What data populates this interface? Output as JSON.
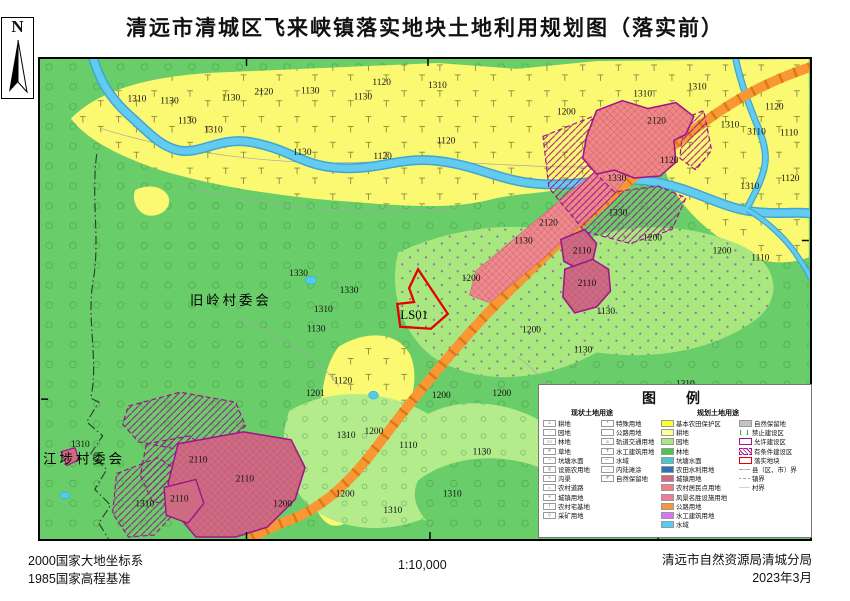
{
  "title": "清远市清城区飞来峡镇落实地块土地利用规划图（落实前）",
  "compass": {
    "label": "N"
  },
  "footer": {
    "datum_line1": "2000国家大地坐标系",
    "datum_line2": "1985国家高程基准",
    "scale": "1:10,000",
    "agency": "清远市自然资源局清城分局",
    "date": "2023年3月"
  },
  "legend": {
    "title": "图　例",
    "current_header": "现状土地用途",
    "planned_header": "规划土地用途",
    "current_col1": [
      {
        "glyph": "⊥",
        "label": "耕地"
      },
      {
        "glyph": "∵",
        "label": "园地"
      },
      {
        "glyph": "○○",
        "label": "林地"
      },
      {
        "glyph": "#",
        "label": "草地"
      },
      {
        "glyph": "~",
        "label": "坑塘水面"
      },
      {
        "glyph": "||",
        "label": "设施农用地"
      },
      {
        "glyph": "≈",
        "label": "沟渠"
      },
      {
        "glyph": "=",
        "label": "农村道路"
      },
      {
        "glyph": "×",
        "label": "城镇用地"
      },
      {
        "glyph": "/",
        "label": "农村宅基地"
      },
      {
        "glyph": "◇",
        "label": "采矿用地"
      }
    ],
    "current_col2": [
      {
        "glyph": "*",
        "label": "特殊用地"
      },
      {
        "glyph": "",
        "label": "公路用地"
      },
      {
        "glyph": "≡",
        "label": "轨道交通用地"
      },
      {
        "glyph": "T",
        "label": "水工建筑用地"
      },
      {
        "glyph": "–·",
        "label": "水域"
      },
      {
        "glyph": "…",
        "label": "内陆滩涂"
      },
      {
        "glyph": "#",
        "label": "自然保留地"
      }
    ],
    "planned_col3": [
      {
        "color": "#FFFF33",
        "label": "基本农田保护区"
      },
      {
        "color": "#FFFF99",
        "label": "耕地"
      },
      {
        "color": "#A8E87E",
        "label": "园地"
      },
      {
        "color": "#4FC24F",
        "label": "林地"
      },
      {
        "color": "#40CCCC",
        "label": "坑塘水面"
      },
      {
        "color": "#2E74B5",
        "label": "农田水利用地"
      },
      {
        "color": "#D46680",
        "label": "城镇用地"
      },
      {
        "color": "#F08080",
        "label": "农村居民点用地"
      },
      {
        "color": "#F2799B",
        "label": "风景名胜设施用地"
      },
      {
        "color": "#F99735",
        "label": "公路用地"
      },
      {
        "color": "#D577F2",
        "label": "水工建筑用地"
      },
      {
        "color": "#55CCF2",
        "label": "水域"
      }
    ],
    "planned_col4": [
      {
        "color": "#C4C4C4",
        "label": "自然保留地"
      },
      {
        "glyph": "[ ]",
        "css": "background:none;border:none;color:#1FA01F;font-weight:700;font-size:7px;letter-spacing:1px",
        "label": "禁止建设区"
      },
      {
        "css": "background:#fff;border:1.2px solid #A0148C",
        "label": "允许建设区"
      },
      {
        "css": "background:repeating-linear-gradient(45deg,#fff 0 2px,#A0148C 2px 3px);border:1px dashed #A0148C",
        "label": "有条件建设区"
      },
      {
        "css": "background:#fff;border:1.2px solid #E60000",
        "label": "落实地块"
      },
      {
        "glyph": "—·—",
        "css": "background:none;border:none;color:#333;font-size:6px",
        "label": "县（区、市）界"
      },
      {
        "glyph": "– – –",
        "css": "background:none;border:none;color:#333;font-size:6px",
        "label": "镇界"
      },
      {
        "glyph": "——",
        "css": "background:none;border:none;color:#999;font-size:6px",
        "label": "村界"
      }
    ]
  },
  "map": {
    "plot_code": "LS01",
    "village_names": [
      "旧岭村委会",
      "江埗村委会"
    ],
    "labels": [
      {
        "x": 87,
        "y": 43,
        "t": "1310"
      },
      {
        "x": 120,
        "y": 45,
        "t": "1130"
      },
      {
        "x": 182,
        "y": 42,
        "t": "1130"
      },
      {
        "x": 215,
        "y": 36,
        "t": "2120"
      },
      {
        "x": 262,
        "y": 35,
        "t": "1130"
      },
      {
        "x": 315,
        "y": 41,
        "t": "1130"
      },
      {
        "x": 334,
        "y": 26,
        "t": "1120"
      },
      {
        "x": 390,
        "y": 29,
        "t": "1310"
      },
      {
        "x": 399,
        "y": 85,
        "t": "1120"
      },
      {
        "x": 164,
        "y": 74,
        "t": "1310"
      },
      {
        "x": 138,
        "y": 65,
        "t": "1130"
      },
      {
        "x": 254,
        "y": 97,
        "t": "1130"
      },
      {
        "x": 335,
        "y": 101,
        "t": "1120"
      },
      {
        "x": 520,
        "y": 56,
        "t": "1200"
      },
      {
        "x": 597,
        "y": 38,
        "t": "1310"
      },
      {
        "x": 652,
        "y": 31,
        "t": "1310"
      },
      {
        "x": 611,
        "y": 65,
        "t": "2120"
      },
      {
        "x": 730,
        "y": 51,
        "t": "1120"
      },
      {
        "x": 685,
        "y": 69,
        "t": "1310"
      },
      {
        "x": 712,
        "y": 76,
        "t": "3110"
      },
      {
        "x": 745,
        "y": 77,
        "t": "1110"
      },
      {
        "x": 746,
        "y": 123,
        "t": "1120"
      },
      {
        "x": 705,
        "y": 131,
        "t": "1310"
      },
      {
        "x": 624,
        "y": 105,
        "t": "1120"
      },
      {
        "x": 571,
        "y": 123,
        "t": "1330"
      },
      {
        "x": 250,
        "y": 219,
        "t": "1330"
      },
      {
        "x": 301,
        "y": 236,
        "t": "1330"
      },
      {
        "x": 275,
        "y": 255,
        "t": "1310"
      },
      {
        "x": 268,
        "y": 275,
        "t": "1130"
      },
      {
        "x": 424,
        "y": 224,
        "t": "1200"
      },
      {
        "x": 502,
        "y": 168,
        "t": "2120"
      },
      {
        "x": 477,
        "y": 186,
        "t": "1130"
      },
      {
        "x": 536,
        "y": 196,
        "t": "2110"
      },
      {
        "x": 541,
        "y": 229,
        "t": "2110"
      },
      {
        "x": 607,
        "y": 183,
        "t": "1200"
      },
      {
        "x": 677,
        "y": 196,
        "t": "1200"
      },
      {
        "x": 716,
        "y": 203,
        "t": "1110"
      },
      {
        "x": 560,
        "y": 257,
        "t": "1130"
      },
      {
        "x": 485,
        "y": 276,
        "t": "1200"
      },
      {
        "x": 572,
        "y": 158,
        "t": "1330"
      },
      {
        "x": 295,
        "y": 327,
        "t": "1120"
      },
      {
        "x": 267,
        "y": 340,
        "t": "1201"
      },
      {
        "x": 298,
        "y": 382,
        "t": "1310"
      },
      {
        "x": 326,
        "y": 378,
        "t": "1200"
      },
      {
        "x": 361,
        "y": 392,
        "t": "1110"
      },
      {
        "x": 394,
        "y": 342,
        "t": "1200"
      },
      {
        "x": 435,
        "y": 399,
        "t": "1130"
      },
      {
        "x": 455,
        "y": 340,
        "t": "1200"
      },
      {
        "x": 405,
        "y": 441,
        "t": "1310"
      },
      {
        "x": 345,
        "y": 458,
        "t": "1310"
      },
      {
        "x": 297,
        "y": 441,
        "t": "1200"
      },
      {
        "x": 537,
        "y": 296,
        "t": "1130"
      },
      {
        "x": 640,
        "y": 330,
        "t": "1310"
      },
      {
        "x": 30,
        "y": 391,
        "t": "1310"
      },
      {
        "x": 149,
        "y": 407,
        "t": "2110"
      },
      {
        "x": 196,
        "y": 426,
        "t": "2110"
      },
      {
        "x": 130,
        "y": 446,
        "t": "2110"
      },
      {
        "x": 95,
        "y": 451,
        "t": "1310"
      },
      {
        "x": 234,
        "y": 451,
        "t": "1200"
      },
      {
        "x": 150,
        "y": 248,
        "t": "旧岭村委会",
        "cls": "vill"
      },
      {
        "x": 2,
        "y": 408,
        "t": "江埗村委会",
        "cls": "vill"
      },
      {
        "x": 362,
        "y": 262,
        "t": "LS01",
        "cls": "plot"
      }
    ]
  },
  "colors": {
    "forest": "#69CD69",
    "farmland": "#FBF871",
    "orchard": "#A8E87E",
    "river": "#57C1E8",
    "road": "#F99735",
    "urban": "#CE6B83",
    "village_residential": "#F08784",
    "plot_outline": "#E60000",
    "construction_boundary": "#A0148C"
  }
}
